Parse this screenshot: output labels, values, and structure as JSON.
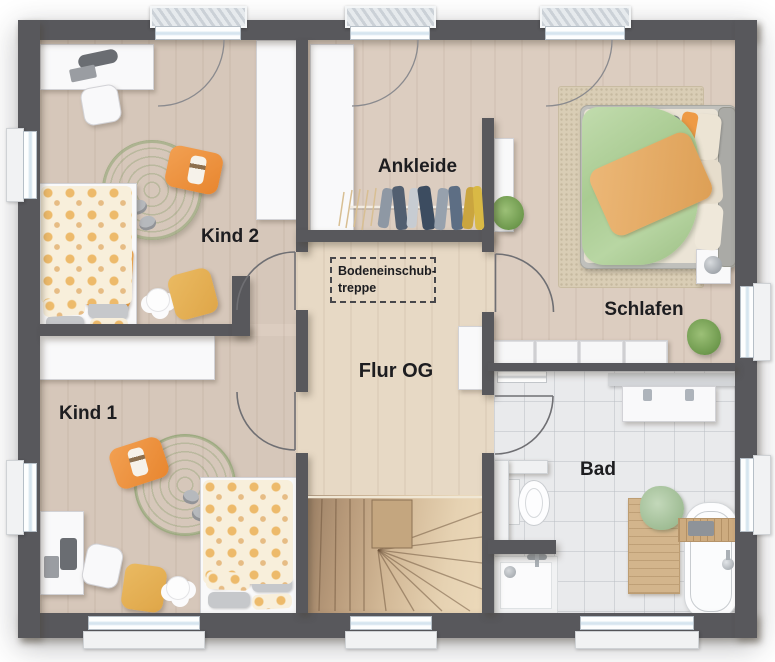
{
  "plan_labels": {
    "kind2": "Kind 2",
    "kind1": "Kind 1",
    "ankleide": "Ankleide",
    "schlafen": "Schlafen",
    "flur": "Flur OG",
    "bad": "Bad"
  },
  "annotations": {
    "attic_hatch_line1": "Bodeneinschub-",
    "attic_hatch_line2": "treppe"
  },
  "colors": {
    "wall": "#58585c",
    "wood_floor": "#dccdc0",
    "hall_floor": "#e7d9c5",
    "tile_floor": "#e9eaec",
    "stair_wood": "#c9b193",
    "accent_orange": "#ef9440",
    "rug_green": "#a3c187",
    "duvet_green": "#b3d29c",
    "mustard": "#e4ae52"
  }
}
